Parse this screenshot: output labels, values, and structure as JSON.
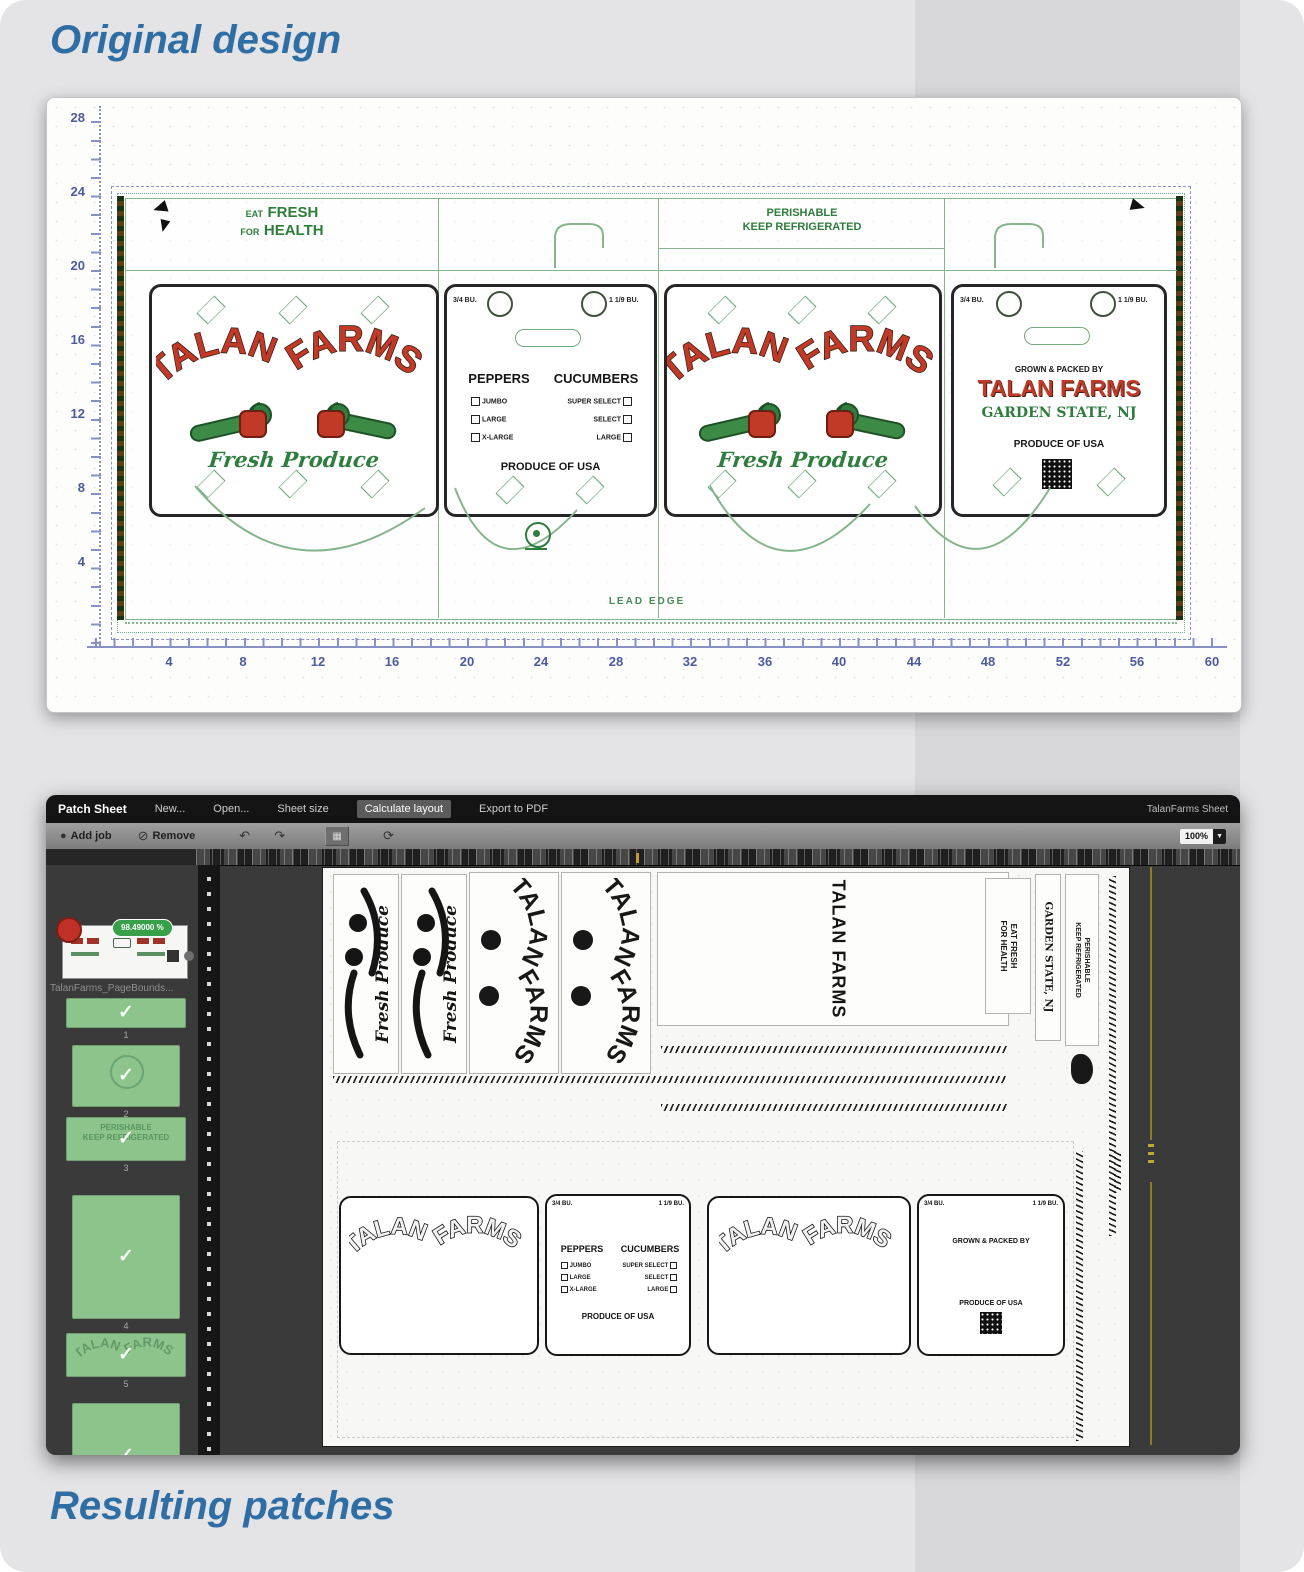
{
  "titles": {
    "top": "Original design",
    "bottom": "Resulting patches"
  },
  "viewer": {
    "v_ruler": [
      "28",
      "24",
      "20",
      "16",
      "12",
      "8",
      "4"
    ],
    "h_ruler": [
      "4",
      "8",
      "12",
      "16",
      "20",
      "24",
      "28",
      "32",
      "36",
      "40",
      "44",
      "48",
      "52",
      "56",
      "60"
    ],
    "carton": {
      "eat_small1": "EAT",
      "eat_big1": "FRESH",
      "eat_small2": "FOR",
      "eat_big2": "HEALTH",
      "perish1": "PERISHABLE",
      "perish2": "KEEP REFRIGERATED",
      "lead_edge": "LEAD EDGE",
      "brand_word1": "TALAN",
      "brand_word2": "FARMS",
      "brand_script": "Fresh Produce",
      "size_left": "3/4 BU.",
      "size_right": "1 1/9 BU.",
      "veg_head_left": "PEPPERS",
      "veg_head_right": "CUCUMBERS",
      "grades_left": [
        "JUMBO",
        "LARGE",
        "X-LARGE"
      ],
      "grades_right": [
        "SUPER SELECT",
        "SELECT",
        "LARGE"
      ],
      "origin": "PRODUCE OF USA",
      "grown_by": "GROWN & PACKED BY",
      "brand_full": "TALAN FARMS",
      "state": "GARDEN STATE, NJ"
    }
  },
  "app": {
    "title": "Patch Sheet",
    "menu": [
      "New...",
      "Open...",
      "Sheet size",
      "Calculate layout",
      "Export to PDF"
    ],
    "doc_name": "TalanFarms Sheet",
    "add_job": "Add job",
    "remove": "Remove",
    "zoom": "100%",
    "coverage": "98.49000 %",
    "filename": "TalanFarms_PageBounds...",
    "thumb_numbers": [
      "1",
      "2",
      "3",
      "4",
      "5",
      "6"
    ],
    "thumb_ghost1": "PERISHABLE",
    "thumb_ghost2": "KEEP REFRIGERATED",
    "patches": {
      "vertical_brand": "TALAN FARMS",
      "brand_word1": "TALAN",
      "brand_word2": "FARMS",
      "script": "Fresh Produce",
      "eat1": "EAT FRESH",
      "eat2": "FOR HEALTH",
      "state": "GARDEN STATE, NJ",
      "perish1": "PERISHABLE",
      "perish2": "KEEP REFRIGERATED",
      "head_left": "PEPPERS",
      "head_right": "CUCUMBERS",
      "grades_left": [
        "JUMBO",
        "LARGE",
        "X-LARGE"
      ],
      "grades_right": [
        "SUPER SELECT",
        "SELECT",
        "LARGE"
      ],
      "origin": "PRODUCE OF USA",
      "grown_by": "GROWN & PACKED BY",
      "size_left": "3/4 BU.",
      "size_right": "1 1/9 BU."
    }
  }
}
